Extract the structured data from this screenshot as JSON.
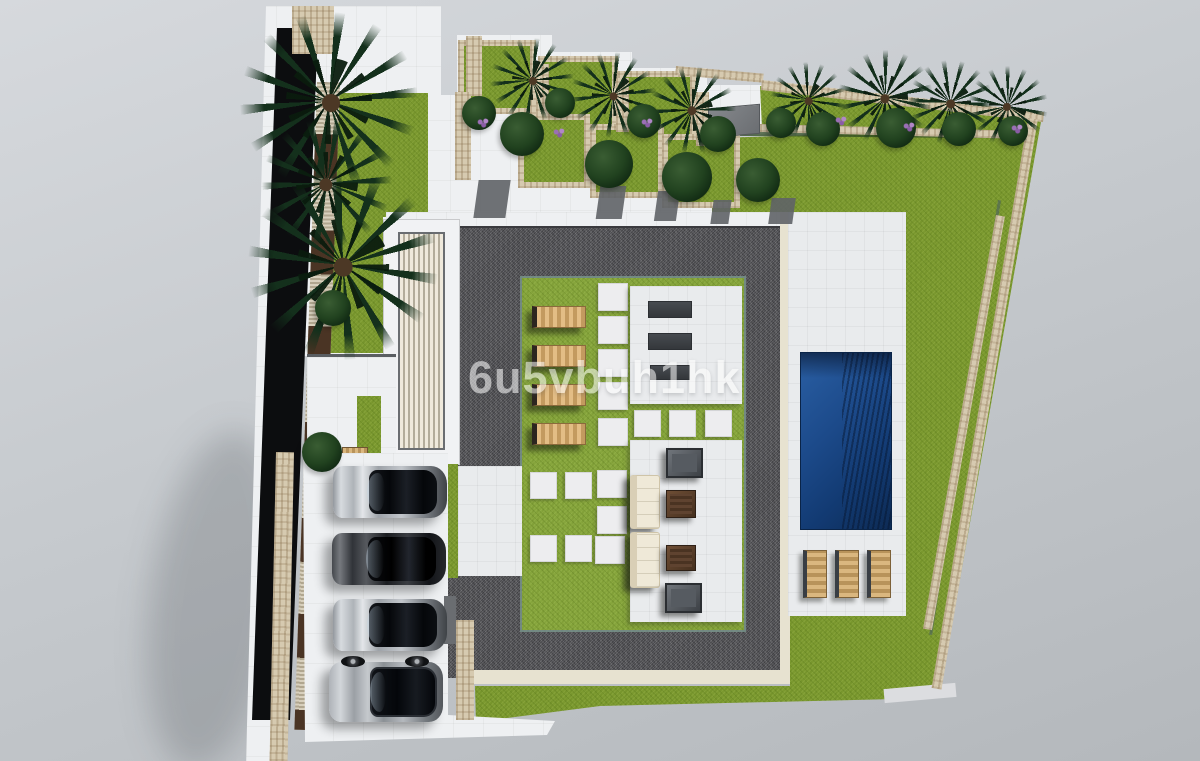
{
  "watermark": {
    "text": "6u5vbuh1hk"
  },
  "colors": {
    "bg_top": "#d6d9dd",
    "bg_bottom": "#b4b8bc",
    "lawn_green": "#7b992f",
    "courtyard_green": "#86a53c",
    "gravel": "#58585c",
    "stone": "#d6cab0",
    "cream_trim": "#e7e2d0",
    "white_surface": "#eef0f2",
    "deck_white": "#e9ebed",
    "pool_blue": "#1c4a8a",
    "pool_dark": "#0d2b55",
    "lounger_wood": "#c39a5f",
    "wood_dark": "#4a3424",
    "building_black": "#0c0d0f",
    "palm_green": "#14301c",
    "bush_green": "#21421f",
    "sofa_cream": "#efe9d8",
    "cube_brown": "#5f4330",
    "cube_gray": "#565b61",
    "flower_purple": "#9b6fb5",
    "shadow_gray": "#5f6367",
    "watermark": "#ffffff"
  },
  "scene": {
    "parked_cars": [
      "silver",
      "black",
      "silver",
      "black-silver-suv"
    ],
    "courtyard_sun_loungers": 4,
    "pool_sun_loungers": 3,
    "swimming_pools": 1
  }
}
